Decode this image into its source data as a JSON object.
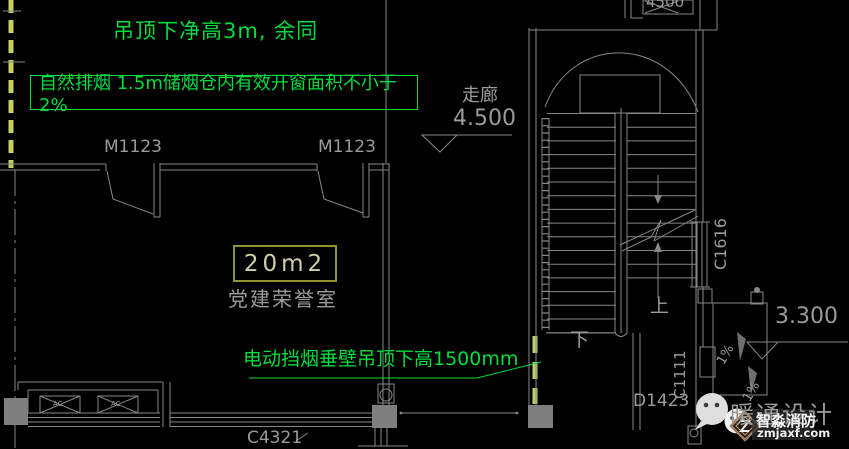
{
  "colors": {
    "background": "#000000",
    "line_gray": "#878787",
    "text_gray": "#9b9b9b",
    "annotation_green": "#00dd3e",
    "dashed_yellow_green": "#c6cf63",
    "area_box_olive": "#8f9431",
    "column_fill": "#7f7f7f"
  },
  "annotations": {
    "ceiling_note": "吊顶下净高3m, 余同",
    "smoke_note": "自然排烟  1.5m储烟仓内有效开窗面积不小于2%",
    "smoke_curtain_note": "电动挡烟垂壁吊顶下高1500mm"
  },
  "rooms": {
    "name": "党建荣誉室",
    "area": "20m2",
    "corridor": "走廊",
    "corridor_elevation": "4.500",
    "landing_elevation": "3.300"
  },
  "openings": {
    "door_left": "M1123",
    "door_right": "M1123",
    "door_stair": "D1423",
    "window_bottom": "C4321",
    "window_stair_right": "C1616",
    "window_stair_bottom": "C1111",
    "top_partial_label": "4500"
  },
  "stair": {
    "up": "上",
    "down": "下"
  },
  "slopes": {
    "slope_a": "1%",
    "slope_b": "1%"
  },
  "equipment": {
    "ac_left": "AC",
    "ac_right": "AC"
  },
  "watermark": {
    "brand": "暖通设计",
    "subbrand": "智淼消防",
    "url": "zmjaxf.com"
  }
}
